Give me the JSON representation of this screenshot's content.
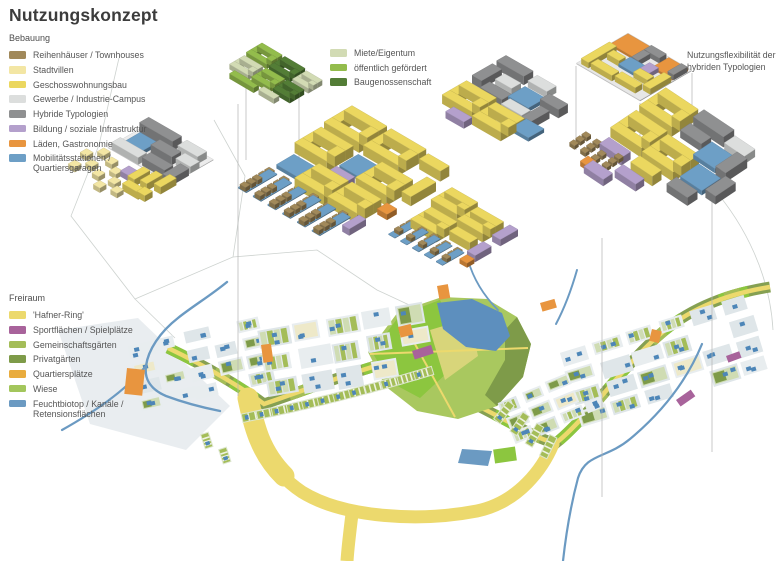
{
  "title": "Nutzungskonzept",
  "annotations": {
    "flex_note": "Nutzungsflexibilität der hybriden Typologien"
  },
  "legends": {
    "bebauung": {
      "heading": "Bebauung",
      "items": [
        {
          "key": "reihenhaus",
          "label": "Reihenhäuser / Townhouses",
          "color": "#a1895a"
        },
        {
          "key": "stadtvilla",
          "label": "Stadtvillen",
          "color": "#f3e6a4"
        },
        {
          "key": "geschoss",
          "label": "Geschosswohnungsbau",
          "color": "#ebd75f"
        },
        {
          "key": "gewerbe",
          "label": "Gewerbe / Industrie-Campus",
          "color": "#dcdedd"
        },
        {
          "key": "hybrid",
          "label": "Hybride Typologien",
          "color": "#8f9091"
        },
        {
          "key": "bildung",
          "label": "Bildung / soziale Infrastruktur",
          "color": "#b4a0cc"
        },
        {
          "key": "laeden",
          "label": "Läden, Gastronomie",
          "color": "#e8953f"
        },
        {
          "key": "mobilitaet",
          "label": "Mobilitätsstationen / Quartiersgaragen",
          "color": "#6d9fc6"
        }
      ]
    },
    "eigentum": {
      "heading": "",
      "items": [
        {
          "key": "miete",
          "label": "Miete/Eigentum",
          "color": "#d2dbb4"
        },
        {
          "key": "gefoerdert",
          "label": "öffentlich gefördert",
          "color": "#93bc4c"
        },
        {
          "key": "genossenschaft",
          "label": "Baugenossenschaft",
          "color": "#537d36"
        }
      ]
    },
    "freiraum": {
      "heading": "Freiraum",
      "items": [
        {
          "key": "ring",
          "label": "'Hafner-Ring'",
          "color": "#ecd96d"
        },
        {
          "key": "sport",
          "label": "Sportflächen / Spielplätze",
          "color": "#a8639b"
        },
        {
          "key": "gemeinschaft",
          "label": "Gemeinschaftsgärten",
          "color": "#a4bd58",
          "striped": true
        },
        {
          "key": "privatgarten",
          "label": "Privatgärten",
          "color": "#7e9b49"
        },
        {
          "key": "quartiersplatz",
          "label": "Quartiersplätze",
          "color": "#e9ac3e"
        },
        {
          "key": "wiese",
          "label": "Wiese",
          "color": "#a3c65c"
        },
        {
          "key": "feuchtbiotop",
          "label": "Feuchtbiotop / Kanäle / Retensionsflächen",
          "color": "#6b9ac2"
        }
      ]
    }
  }
}
